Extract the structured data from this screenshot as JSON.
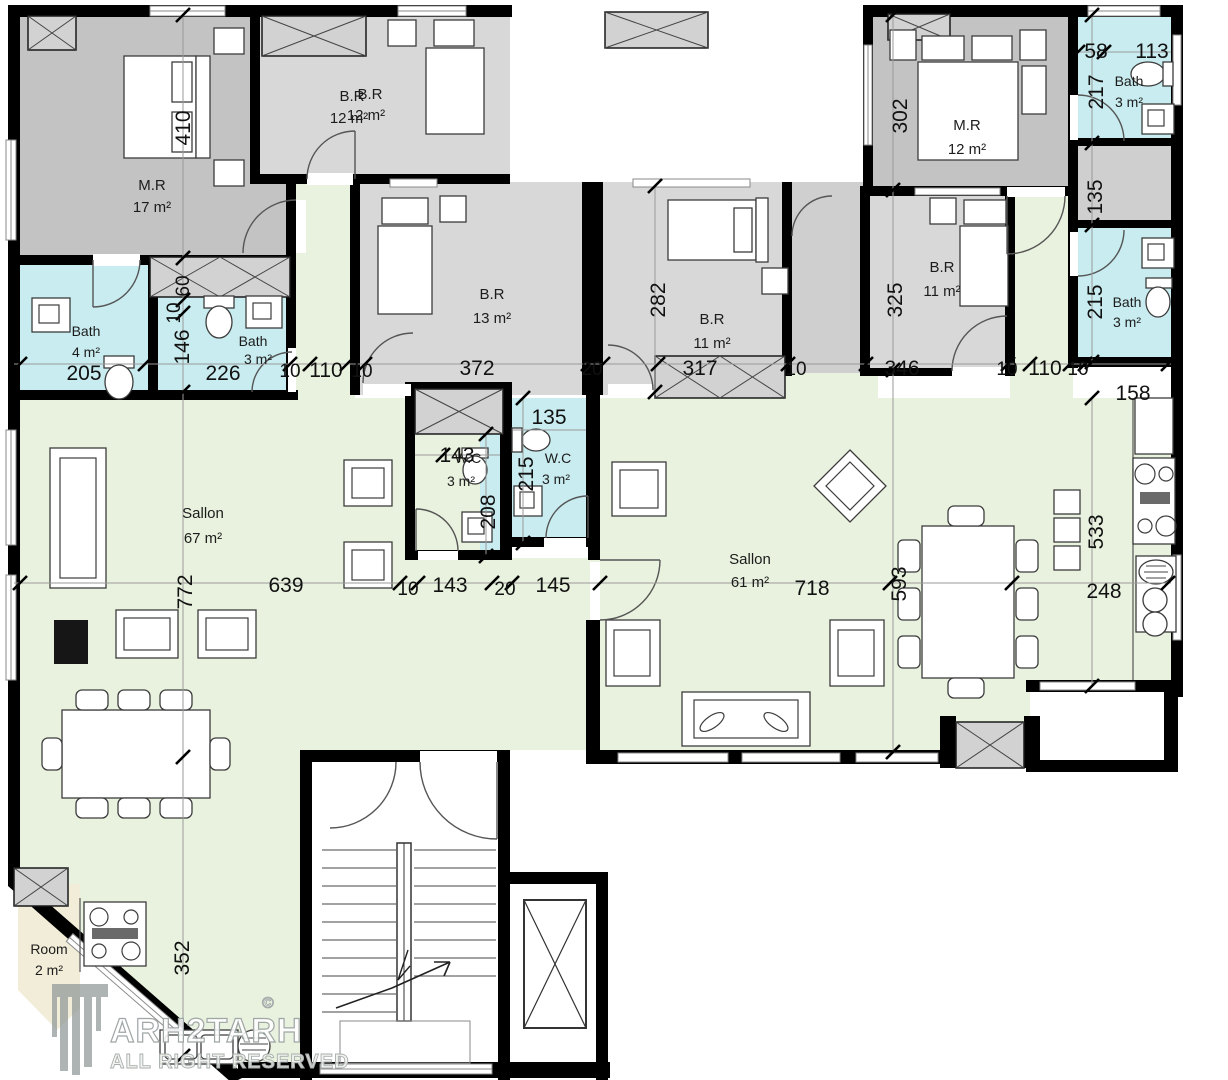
{
  "rooms": {
    "mr17": {
      "name": "M.R",
      "area": "17 m²"
    },
    "br12": {
      "name": "B.R",
      "area": "12 m²"
    },
    "br12b": {
      "name": "B.R",
      "area": "12 m²"
    },
    "br13": {
      "name": "B.R",
      "area": "13 m²"
    },
    "br11a": {
      "name": "B.R",
      "area": "11 m²"
    },
    "br11b": {
      "name": "B.R",
      "area": "11 m²"
    },
    "mr12": {
      "name": "M.R",
      "area": "12 m²"
    },
    "bath4": {
      "name": "Bath",
      "area": "4 m²"
    },
    "bath3a": {
      "name": "Bath",
      "area": "3 m²"
    },
    "bath3b": {
      "name": "Bath",
      "area": "3 m²"
    },
    "bath3c": {
      "name": "Bath",
      "area": "3 m²"
    },
    "wc3a": {
      "name": "W.C",
      "area": "3 m²"
    },
    "wc3b": {
      "name": "W.C",
      "area": "3 m²"
    },
    "sallon67": {
      "name": "Sallon",
      "area": "67 m²"
    },
    "sallon61": {
      "name": "Sallon",
      "area": "61 m²"
    },
    "room2": {
      "name": "Room",
      "area": "2 m²"
    }
  },
  "dims": {
    "v410": "410",
    "v60": "60",
    "v10a": "10",
    "v146": "146",
    "h205": "205",
    "h226": "226",
    "h10b": "10",
    "h110a": "110",
    "h10c": "10",
    "h372": "372",
    "h20a": "20",
    "h317": "317",
    "h10d": "10",
    "h346": "346",
    "h10e": "10",
    "h110b": "110",
    "h10f": "10",
    "h158": "158",
    "h58": "58",
    "h113": "113",
    "v217": "217",
    "v302": "302",
    "v135a": "135",
    "v215a": "215",
    "h135b": "135",
    "h143a": "143",
    "v208": "208",
    "v215b": "215",
    "v282": "282",
    "v325": "325",
    "v772": "772",
    "h639": "639",
    "h10g": "10",
    "h143b": "143",
    "h20b": "20",
    "h145": "145",
    "h718": "718",
    "v593": "593",
    "v533": "533",
    "h248": "248",
    "v352": "352"
  },
  "watermark": {
    "brand": "ARH2TARH",
    "copyright": "©",
    "tagline": "ALL RIGHT RESERVED"
  },
  "colors": {
    "master": "#c3c3c3",
    "bedroom": "#d8d8d8",
    "hall": "#cfcfcf",
    "bath": "#c8ecef",
    "sallon": "#e9f2de",
    "room": "#f2edd8",
    "wall": "#000000"
  }
}
